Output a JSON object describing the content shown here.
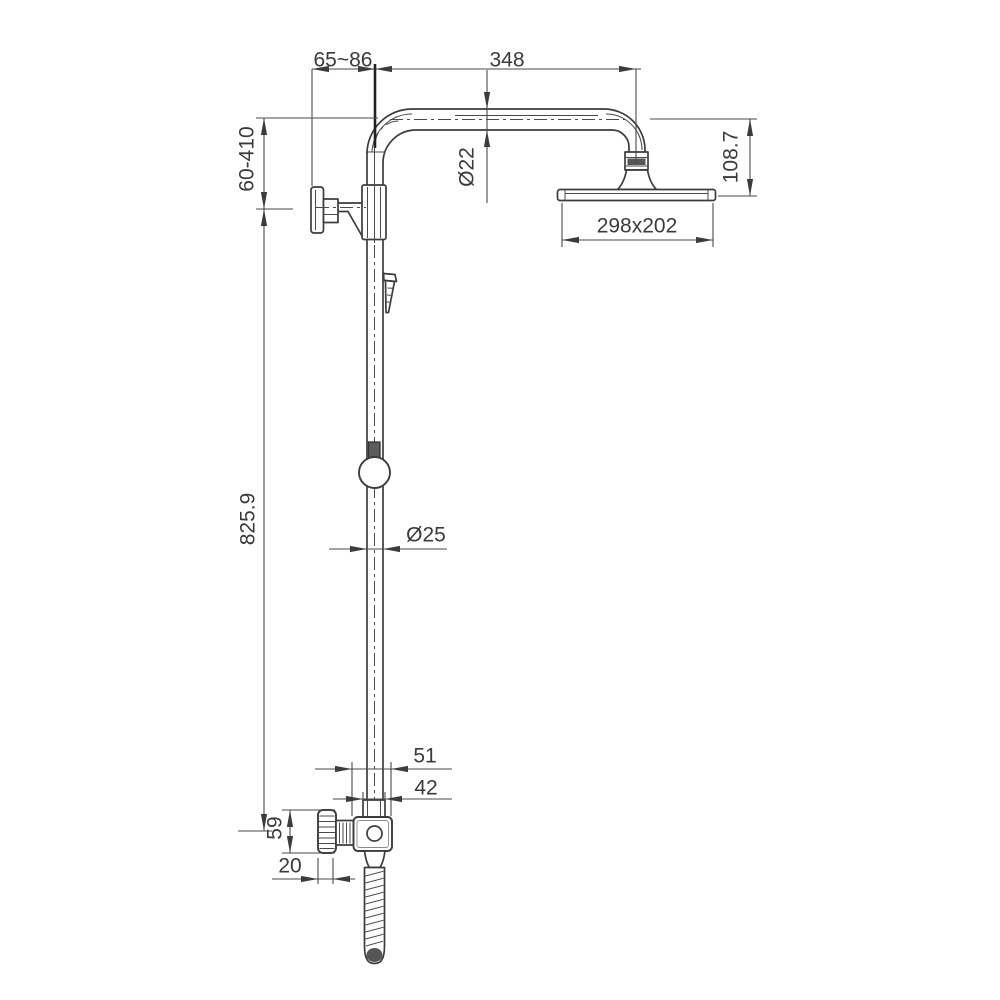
{
  "drawing": {
    "kind": "technical-dimension-drawing",
    "subject": "shower column with overhead rain shower, wall bracket, slider and hand-shower hose",
    "colors": {
      "background": "#ffffff",
      "object_line": "#3c3c3c",
      "dimension_line": "#4a4a4a",
      "label_text": "#3a3a3a",
      "dark_fill": "#565656"
    },
    "dimensions": {
      "wall_offset_range": "65~86",
      "arm_length": "348",
      "bracket_height_range": "60-410",
      "arm_pipe_diameter": "Ø22",
      "head_drop_height": "108.7",
      "head_size": "298x202",
      "column_height": "825.9",
      "column_diameter": "Ø25",
      "bottom_bracket_width": "51",
      "bottom_collar_width": "42",
      "knob_height": "59",
      "knob_depth": "20"
    }
  }
}
